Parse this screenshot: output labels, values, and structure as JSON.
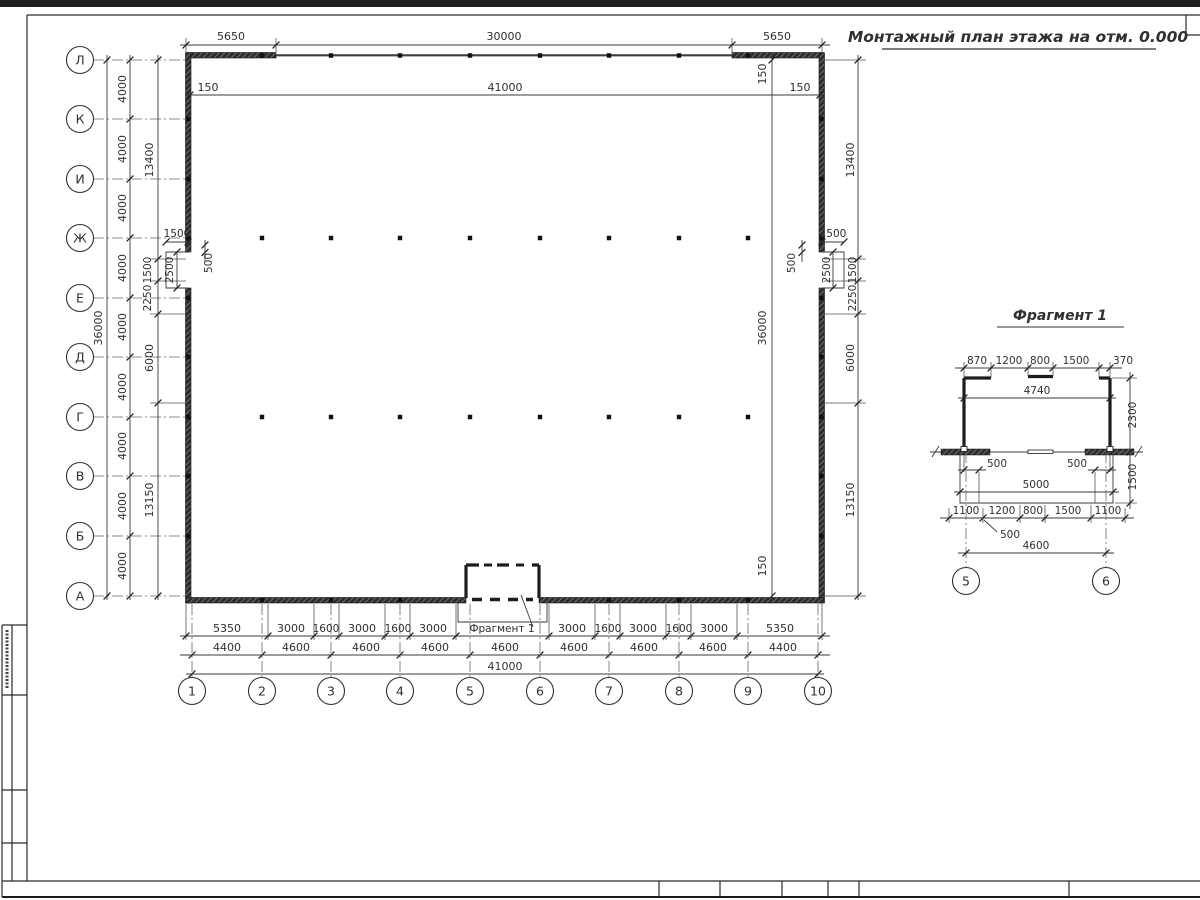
{
  "title": "Монтажный план этажа на отм. 0.000",
  "plan": {
    "axes_rows": [
      "Л",
      "К",
      "И",
      "Ж",
      "Е",
      "Д",
      "Г",
      "В",
      "Б",
      "А"
    ],
    "axes_cols": [
      "1",
      "2",
      "3",
      "4",
      "5",
      "6",
      "7",
      "8",
      "9",
      "10"
    ],
    "dim_top": [
      "5650",
      "30000",
      "5650"
    ],
    "dim_top_inner": [
      "150",
      "41000",
      "150"
    ],
    "dim_left_overall": "36000",
    "dim_left_bays": [
      "4000",
      "4000",
      "4000",
      "4000",
      "4000",
      "4000",
      "4000",
      "4000",
      "4000"
    ],
    "dim_left_chain": [
      "13400",
      "1500",
      "2250",
      "6000",
      "13150"
    ],
    "dim_right_chain": [
      "13400",
      "1500",
      "2250",
      "6000",
      "13150"
    ],
    "dim_right_inner": [
      "150",
      "36000",
      "150"
    ],
    "recess_left": {
      "depth": "1500",
      "opening": "2500",
      "offset": "500"
    },
    "recess_right": {
      "depth": "1500",
      "opening": "2500",
      "offset": "500"
    },
    "dim_bottom_openings": [
      "5350",
      "3000",
      "1600",
      "3000",
      "1600",
      "3000",
      "3000",
      "1600",
      "3000",
      "1600",
      "3000",
      "5350"
    ],
    "fragment_callout": "Фрагмент 1",
    "dim_bottom_bays": [
      "4400",
      "4600",
      "4600",
      "4600",
      "4600",
      "4600",
      "4600",
      "4600",
      "4400"
    ],
    "dim_bottom_total": "41000"
  },
  "fragment": {
    "title": "Фрагмент 1",
    "dim_top": [
      "870",
      "1200",
      "800",
      "1500",
      "370"
    ],
    "dim_width": "4740",
    "dim_height": "2300",
    "dim_apron_depth": "1500",
    "dim_offset_left": "500",
    "dim_offset_right": "500",
    "dim_apron_width": "5000",
    "dim_bottom": [
      "1100",
      "1200",
      "800",
      "1500",
      "1100"
    ],
    "dim_leader": "500",
    "dim_axes_span": "4600",
    "axes": [
      "5",
      "6"
    ]
  }
}
